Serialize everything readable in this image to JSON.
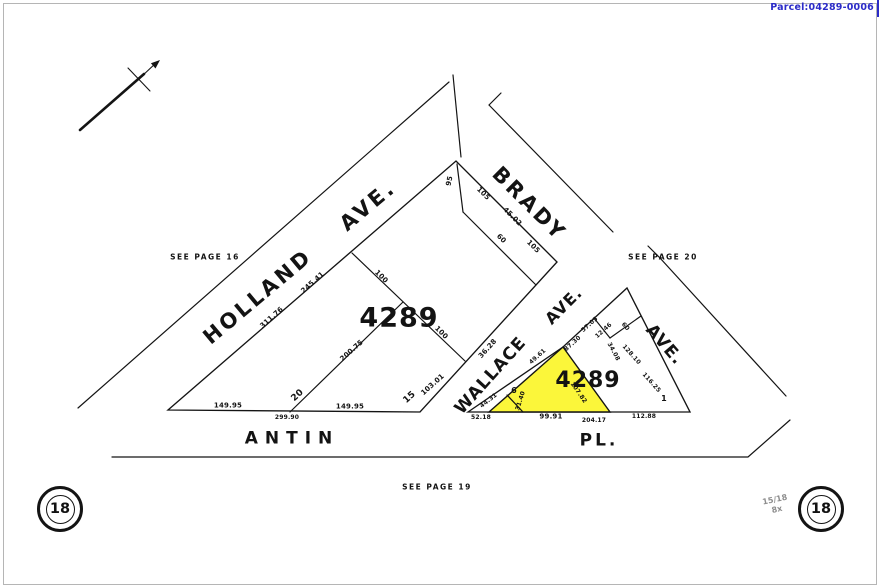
{
  "window": {
    "parcel_id": "Parcel:04289-0006"
  },
  "map": {
    "block_numbers": [
      "4289",
      "4289"
    ],
    "streets": {
      "holland": "HOLLAND",
      "holland_suffix": "AVE.",
      "brady": "BRADY",
      "wallace": "WALLACE",
      "wallace_suffix": "AVE.",
      "unnamed_avenue": "AVE.",
      "antin": "ANTIN",
      "antin_suffix": "PL."
    },
    "page_refs": {
      "west": "SEE PAGE 16",
      "east": "SEE PAGE 20",
      "south": "SEE PAGE 19"
    },
    "page_badges": {
      "left": "18",
      "right": "18"
    },
    "handwritten_note": "15/18 8x",
    "dims": [
      "311.76",
      "245.41",
      "200.75",
      "20",
      "149.95",
      "299.90",
      "149.95",
      "15",
      "103.01",
      "100",
      "100",
      "95",
      "105",
      "45.02",
      "105",
      "60",
      "36.28",
      "44.31",
      "52.18",
      "6",
      "31.40",
      "49.61",
      "99.91",
      "204.17",
      "107.82",
      "87.30",
      "57.05",
      "12.46",
      "60",
      "34.08",
      "128.10",
      "116.25",
      "112.88",
      "1"
    ],
    "colors": {
      "highlight": "#FBF63A",
      "parcel_link": "#2B2BC8",
      "line": "#141414"
    }
  }
}
